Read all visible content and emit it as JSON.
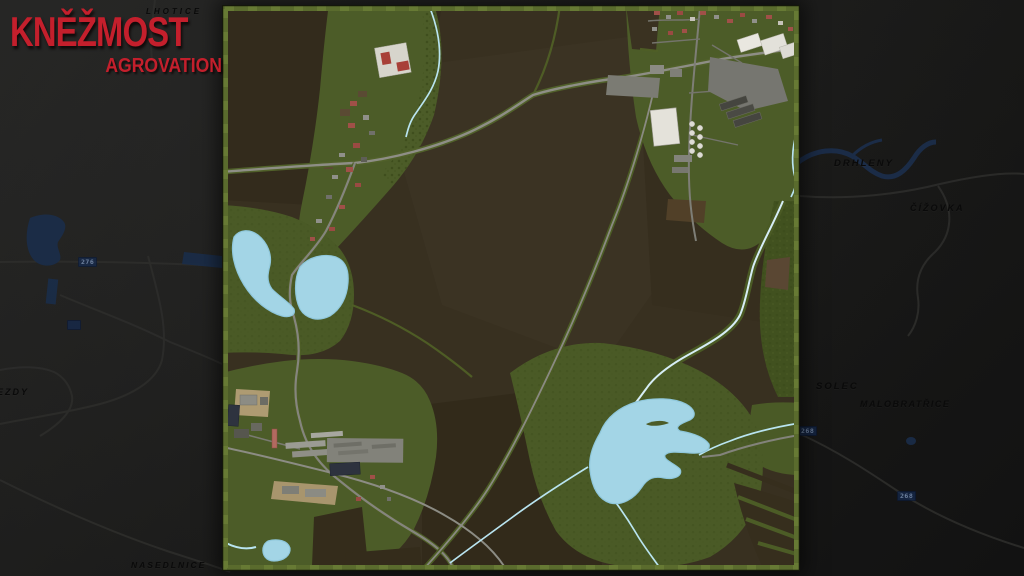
{
  "logo": {
    "title": "KNĚŽMOST",
    "subtitle": "AGROVATION",
    "accent_color": "#c41f2c"
  },
  "background_map": {
    "place_labels": [
      {
        "text": "LHOTICE"
      },
      {
        "text": "DRHLENY"
      },
      {
        "text": "ČÍŽOVKA"
      },
      {
        "text": "SOLEC"
      },
      {
        "text": "MALOBRATŘICE"
      },
      {
        "text": "NASEDLNICE"
      },
      {
        "text": "EZDY"
      }
    ],
    "route_badges": [
      {
        "number": "276"
      },
      {
        "number": ""
      },
      {
        "number": "268"
      },
      {
        "number": "268"
      }
    ],
    "colors": {
      "background": "#1d1d1c",
      "water": "#1b2d4a",
      "road": "#2e2e2c",
      "label": "#0a0a0a"
    }
  },
  "map_preview": {
    "colors": {
      "field_brown": "#383020",
      "grass_green": "#4c5c28",
      "forest_green": "#41511f",
      "lake_blue": "#a3d5e6",
      "stream_blue": "#b9e4f0",
      "road_gray": "#8e8e86",
      "border_green": "#5a6b2d"
    }
  }
}
